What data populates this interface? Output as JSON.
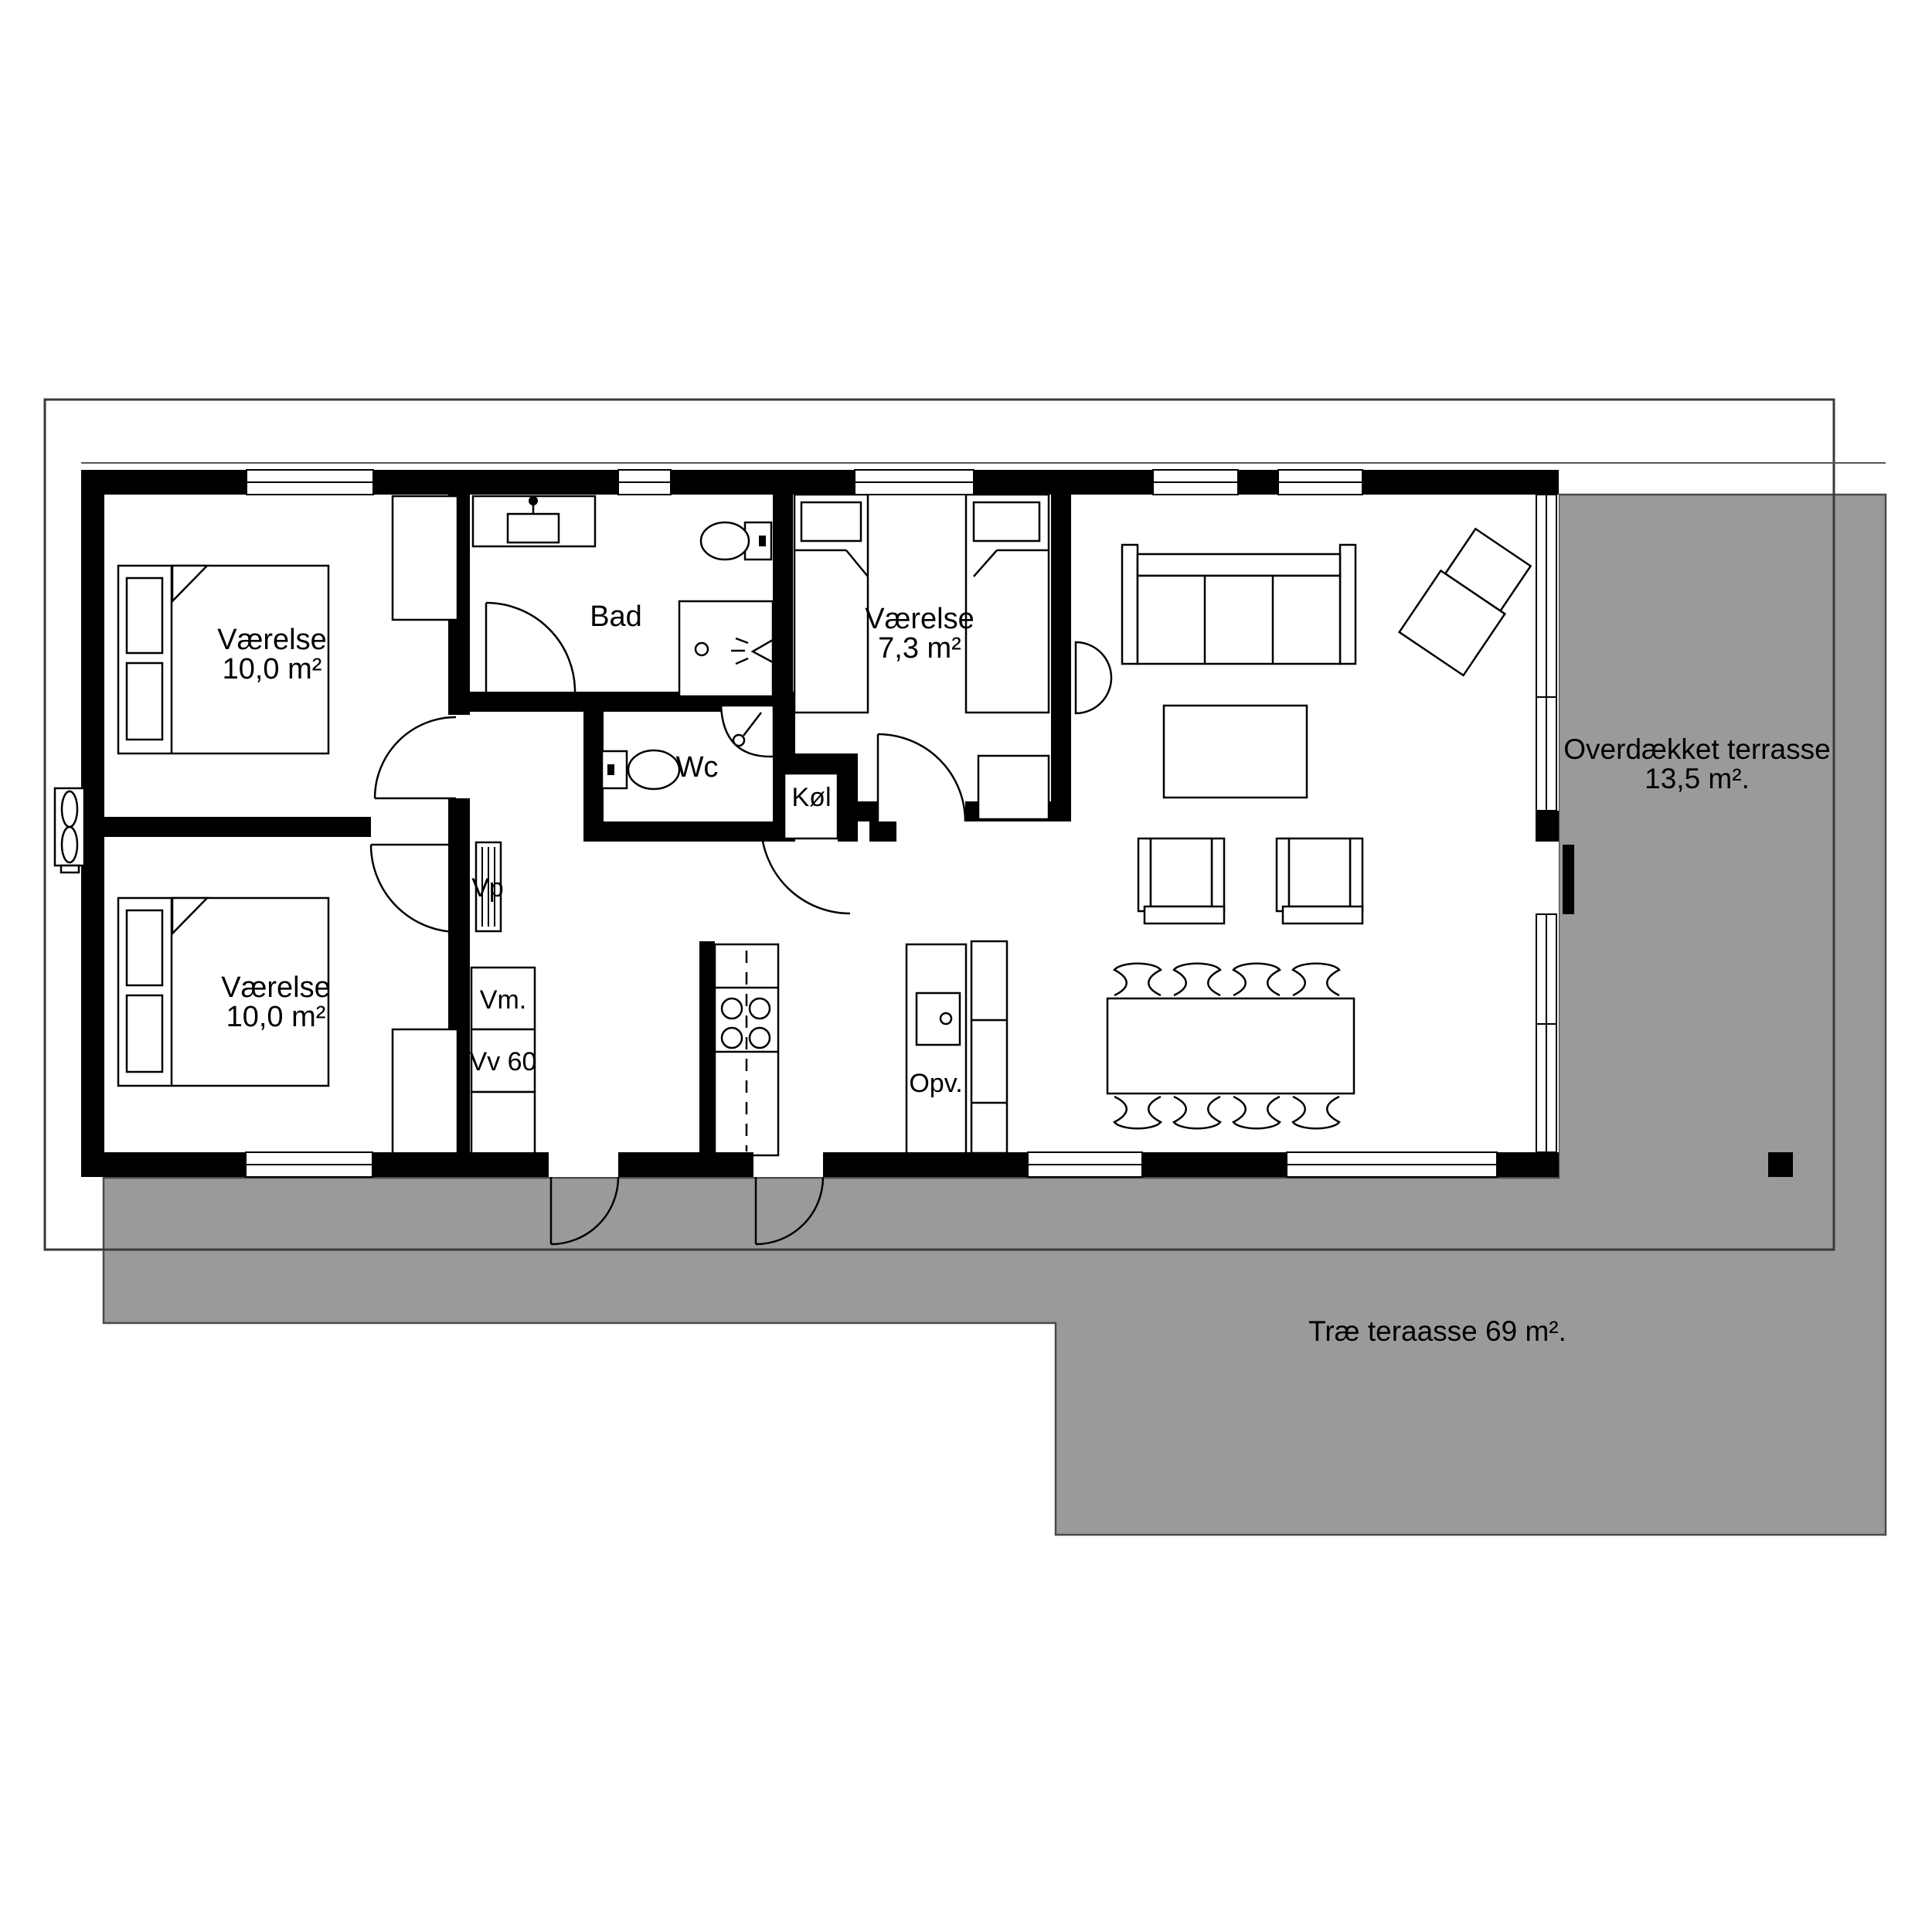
{
  "plan": {
    "type": "floor-plan",
    "language": "da",
    "colors": {
      "terrace_gray": "#9a9a9a",
      "wall": "#000000",
      "boundary_line": "#3a3a3a",
      "background": "#ffffff"
    }
  },
  "rooms": [
    {
      "id": "bedroom-nw",
      "name": "Værelse",
      "area": "10,0 m²"
    },
    {
      "id": "bedroom-sw",
      "name": "Værelse",
      "area": "10,0 m²"
    },
    {
      "id": "bedroom-mid",
      "name": "Værelse",
      "area": "7,3 m²"
    },
    {
      "id": "bathroom",
      "name": "Bad",
      "area": ""
    },
    {
      "id": "wc",
      "name": "Wc",
      "area": ""
    },
    {
      "id": "fridge-niche",
      "name": "Køl",
      "area": ""
    },
    {
      "id": "covered-terrace",
      "name": "Overdækket terrasse",
      "area": "13,5 m²."
    },
    {
      "id": "wood-terrace",
      "name": "Træ teraasse",
      "area": "69 m²."
    }
  ],
  "labels": {
    "bedroom1_name": "Værelse",
    "bedroom1_area": "10,0 m²",
    "bedroom2_name": "Værelse",
    "bedroom2_area": "10,0 m²",
    "bedroom3_name": "Værelse",
    "bedroom3_area": "7,3 m²",
    "bad": "Bad",
    "wc": "Wc",
    "kol": "Køl",
    "vp": "Vp",
    "vm": "Vm.",
    "vv": "Vv 60",
    "opv": "Opv.",
    "covered_terrace_line1": "Overdækket terrasse",
    "covered_terrace_line2": "13,5 m².",
    "wood_terrace": "Træ teraasse 69 m²."
  },
  "fixtures": [
    "double-bed x2",
    "single-bed x2",
    "wardrobe x2",
    "bath-vanity",
    "toilet x2",
    "shower",
    "corner-sink",
    "fridge",
    "stove-4-burners",
    "dishwasher",
    "sofa",
    "lounge-chair",
    "coffee-table",
    "armchair x2",
    "dining-table",
    "dining-chair x8",
    "heat-pump-outdoor-unit",
    "desk",
    "half-round-table"
  ]
}
